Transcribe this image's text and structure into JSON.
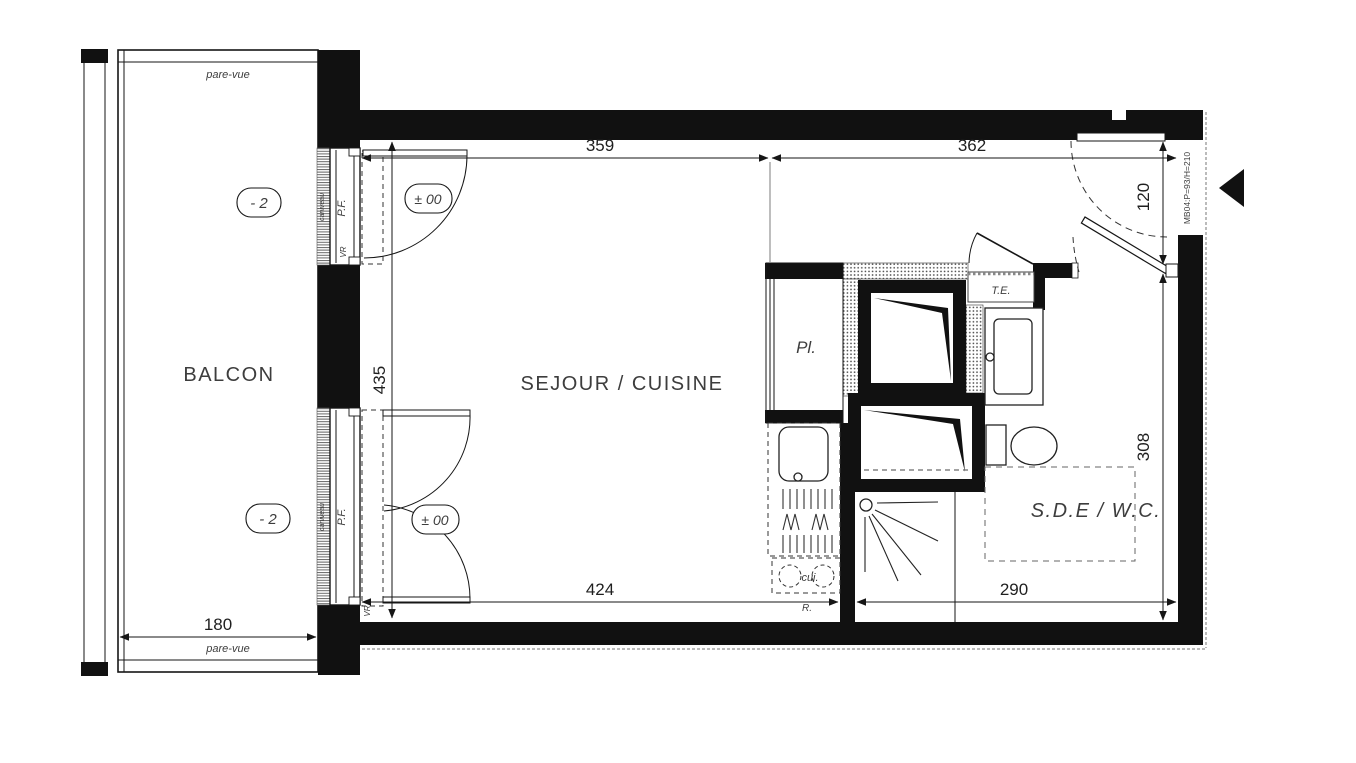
{
  "colors": {
    "ink": "#111111",
    "label_gray": "#3d3d3d",
    "pattern_gray": "#4a4a4a",
    "neighbor_gray": "#bbbbbb"
  },
  "rooms": {
    "balcony": "BALCON",
    "living_kitchen": "SEJOUR / CUISINE",
    "shower_wc": "S.D.E / W.C.",
    "closet": "Pl."
  },
  "labels": {
    "pare_vue": "pare-vue",
    "electrical_panel": "T.E.",
    "cooktop": "cui.",
    "fridge": "R.",
    "french_window": "P.F.",
    "roller_shutter": "VR",
    "drain_channel": "caniveau",
    "entry_door_ref": "MB04:P=93/H=210"
  },
  "levels": {
    "balcony_level": "- 2",
    "floor_level": "± 00"
  },
  "dims": {
    "living_top": "359",
    "entry_top": "362",
    "entry_door_width": "120",
    "living_depth": "435",
    "living_bottom": "424",
    "bath_bottom": "290",
    "bath_depth": "308",
    "balcony_width": "180"
  }
}
